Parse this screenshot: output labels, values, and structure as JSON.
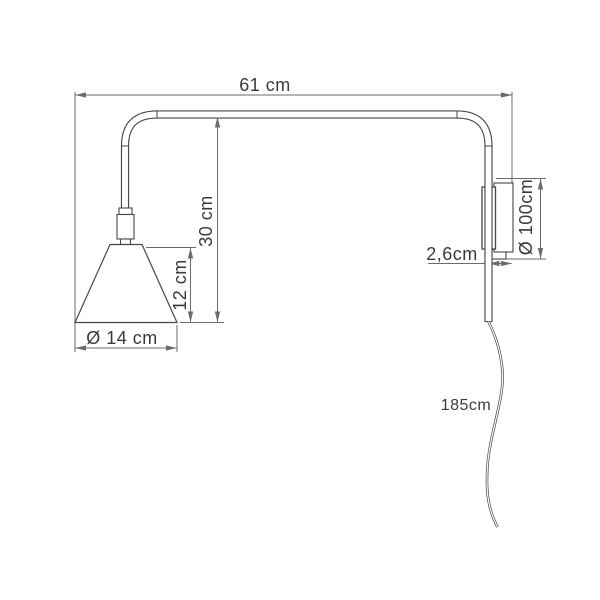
{
  "diagram": {
    "type": "technical-dimension-drawing",
    "subject": "wall lamp with swing arm, side view",
    "colors": {
      "background": "#ffffff",
      "object_line": "#474747",
      "dimension_line": "#6b6b6b",
      "text": "#3a3a3a"
    },
    "labels": {
      "arm_length": "61 cm",
      "drop_height": "30 cm",
      "shade_height": "12 cm",
      "shade_diameter": "Ø 14 cm",
      "bracket_depth": "2,6cm",
      "wall_plate": "Ø 100cm",
      "cable_length": "185cm"
    }
  }
}
